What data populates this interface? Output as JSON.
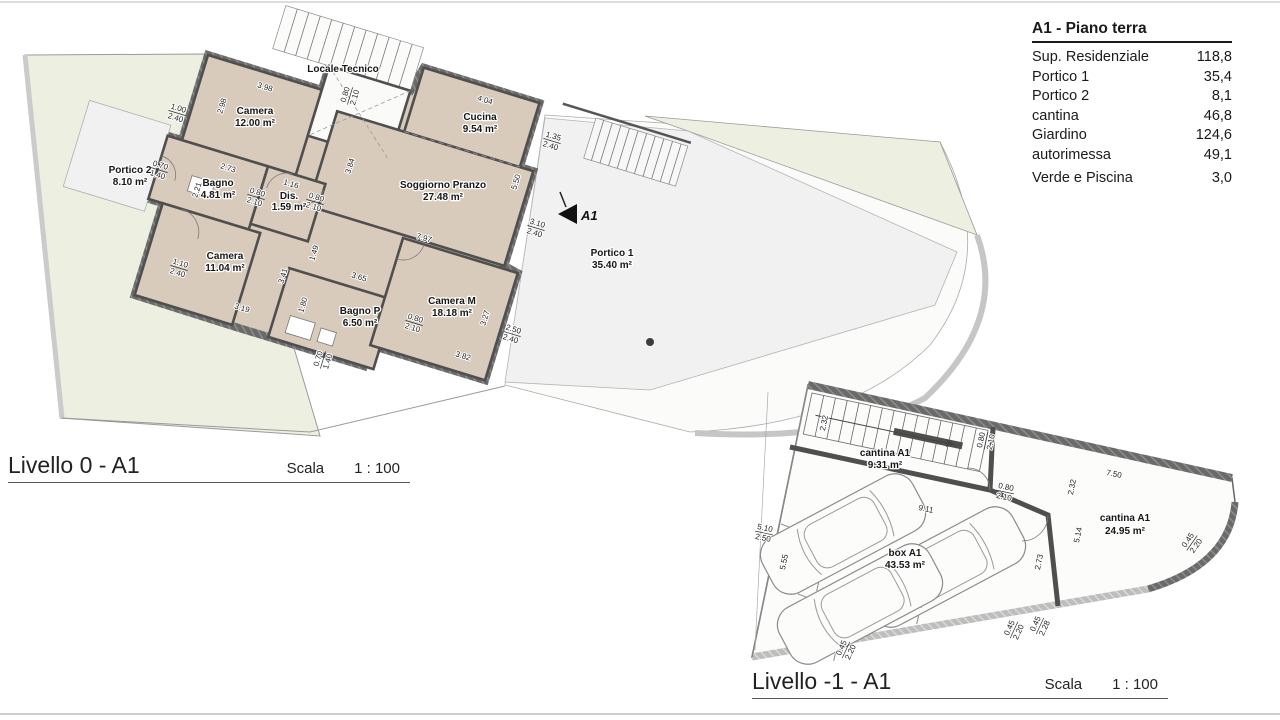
{
  "legend_table": {
    "title": "A1 - Piano terra",
    "rows": [
      {
        "label": "Sup. Residenziale",
        "value": "118,8"
      },
      {
        "label": "Portico 1",
        "value": "35,4"
      },
      {
        "label": "Portico 2",
        "value": "8,1"
      },
      {
        "label": "cantina",
        "value": "46,8"
      },
      {
        "label": "Giardino",
        "value": "124,6"
      },
      {
        "label": "autorimessa",
        "value": "49,1"
      },
      {
        "label": "Verde e Piscina",
        "value": "3,0"
      }
    ]
  },
  "plan0": {
    "title": "Livello 0 - A1",
    "scale_label": "Scala",
    "scale_value": "1 : 100",
    "section_marker": "A1",
    "rooms": [
      {
        "name": "Camera",
        "area": "12.00 m²"
      },
      {
        "name": "Locale Tecnico",
        "area": ""
      },
      {
        "name": "Cucina",
        "area": "9.54 m²"
      },
      {
        "name": "Soggiorno Pranzo",
        "area": "27.48 m²"
      },
      {
        "name": "Bagno",
        "area": "4.81 m²"
      },
      {
        "name": "Dis.",
        "area": "1.59 m²"
      },
      {
        "name": "Camera",
        "area": "11.04 m²"
      },
      {
        "name": "Bagno P",
        "area": "6.50 m²"
      },
      {
        "name": "Camera M",
        "area": "18.18 m²"
      },
      {
        "name": "Portico 1",
        "area": "35.40 m²"
      },
      {
        "name": "Portico 2",
        "area": "8.10 m²"
      }
    ],
    "dims": [
      "3.98",
      "2.98",
      "1.00/2.40",
      "0.80/2.10",
      "4.04",
      "1.35/2.40",
      "5.50",
      "3.84",
      "2.73",
      "2.21",
      "0.70/1.40",
      "0.80/2.10",
      "0.80/2.10",
      "1.16",
      "7.97",
      "3.10/2.40",
      "1.49",
      "3.41",
      "3.65",
      "3.19",
      "1.80",
      "0.80/2.10",
      "3.27",
      "2.50/2.40",
      "3.82",
      "0.70/1.40",
      "1.10/2.40"
    ]
  },
  "plan1": {
    "title": "Livello -1 - A1",
    "scale_label": "Scala",
    "scale_value": "1 : 100",
    "rooms": [
      {
        "name": "cantina A1",
        "area": "9.31 m²"
      },
      {
        "name": "box A1",
        "area": "43.53 m²"
      },
      {
        "name": "cantina A1",
        "area": "24.95 m²"
      }
    ],
    "dims": [
      "2.32",
      "0.80/2.10",
      "0.80/2.10",
      "9.11",
      "5.10/2.50",
      "5.55",
      "2.32",
      "7.50",
      "5.14",
      "2.73",
      "0.45/2.20",
      "0.45/2.20",
      "0.45/2.28",
      "0.45/2.20"
    ]
  },
  "colors": {
    "room_fill": "#d8cbbb",
    "wall": "#6a6a6a",
    "garden": "#edefe0",
    "portico": "#f1f1f1",
    "driveway": "#fbfbfa",
    "boundary_band": "#c6c6c6"
  }
}
